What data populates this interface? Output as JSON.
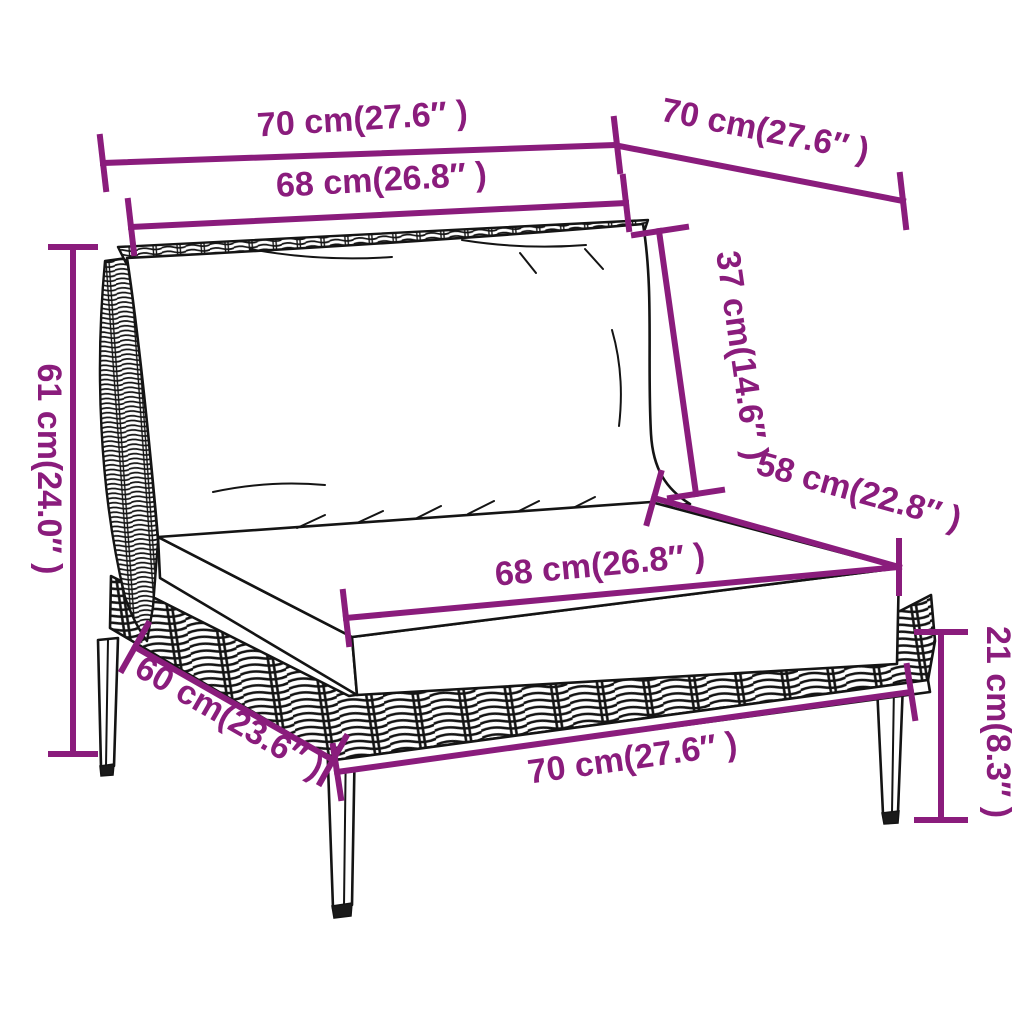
{
  "diagram": {
    "title": "Rattan sofa section dimension diagram",
    "subject": "half-round poly rattan garden sofa middle section with back cushion and seat cushion",
    "style": "black line-art product drawing with magenta dimension lines",
    "background_color": "#ffffff",
    "dimension_color": "#8A1C7C",
    "outline_color": "#141414"
  },
  "measurements": {
    "overall_width": "70 cm(27.6″ )",
    "overall_depth": "70 cm(27.6″ )",
    "back_cushion_width": "68 cm(26.8″ )",
    "back_cushion_height": "37 cm(14.6″ )",
    "seat_cushion_depth": "58 cm(22.8″ )",
    "overall_height": "61 cm(24.0″ )",
    "seat_cushion_width": "68 cm(26.8″ )",
    "frame_depth": "60 cm(23.6″ )",
    "frame_width": "70 cm(27.6″ )",
    "leg_height": "21 cm(8.3″ )"
  }
}
